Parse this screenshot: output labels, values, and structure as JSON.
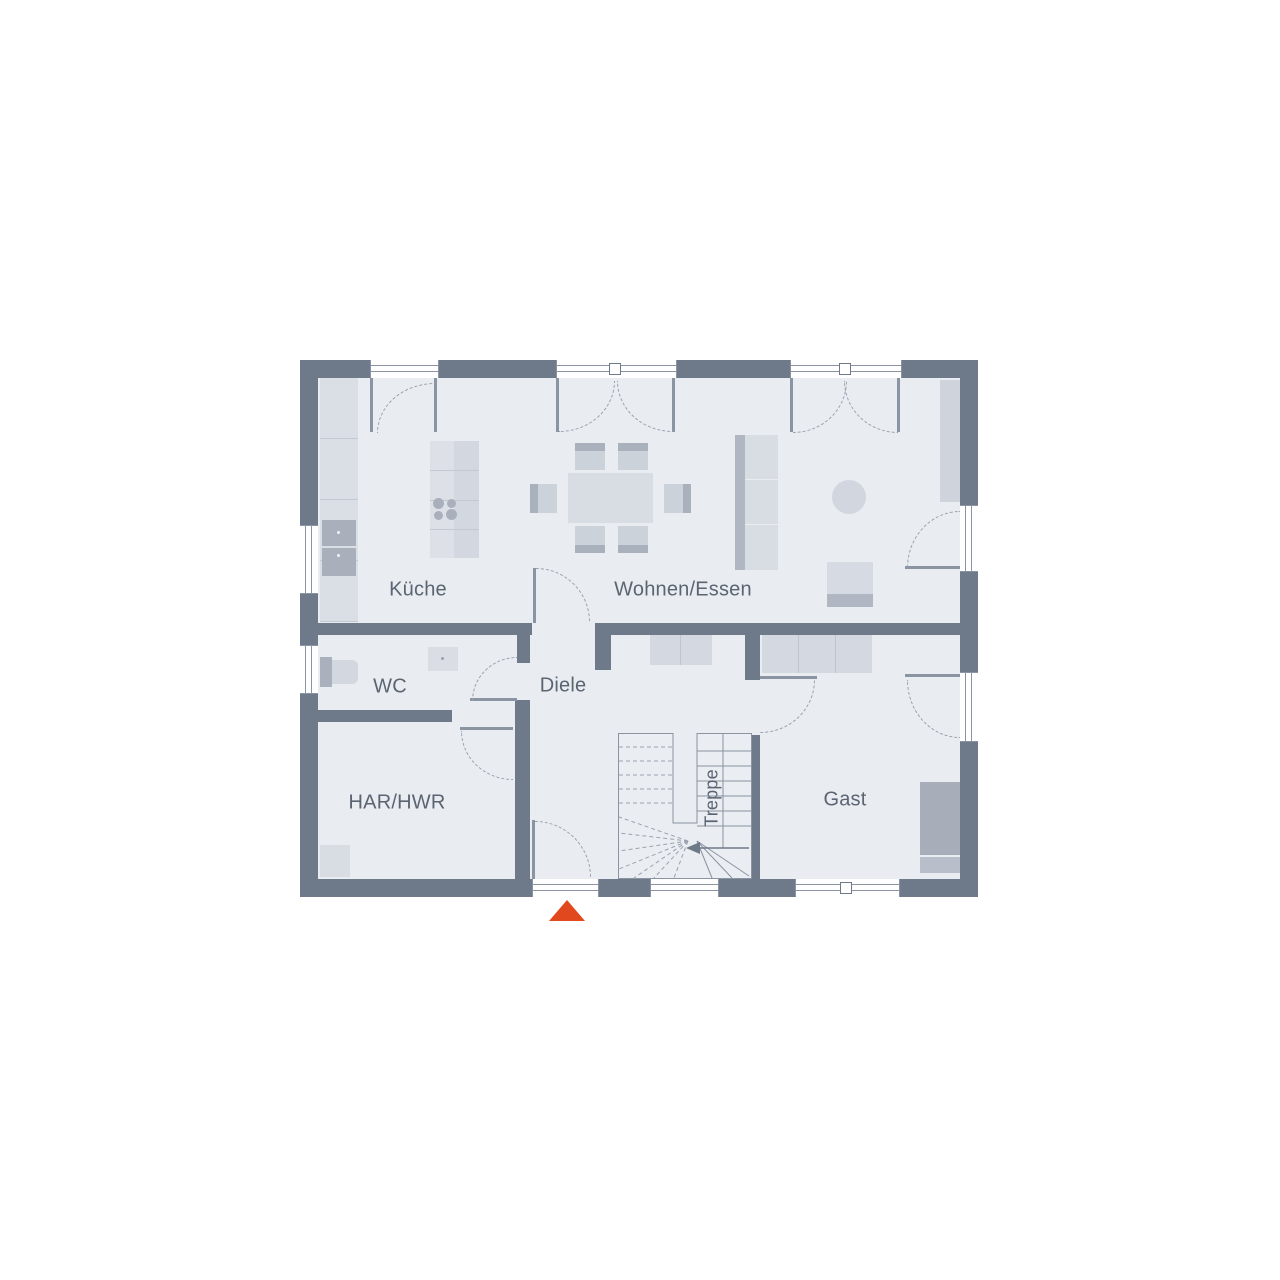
{
  "plan": {
    "type": "floor-plan",
    "rooms": [
      {
        "id": "kueche",
        "label": "Küche"
      },
      {
        "id": "wohnen-essen",
        "label": "Wohnen/Essen"
      },
      {
        "id": "wc",
        "label": "WC"
      },
      {
        "id": "diele",
        "label": "Diele"
      },
      {
        "id": "har-hwr",
        "label": "HAR/HWR"
      },
      {
        "id": "gast",
        "label": "Gast"
      },
      {
        "id": "treppe",
        "label": "Treppe"
      }
    ],
    "colors": {
      "wall": "#6e7a8a",
      "floor": "#e9ecf1",
      "furniture_light": "#d8dce3",
      "furniture_medium": "#c6ccd5",
      "furniture_dark": "#a9b0bc",
      "entrance_marker": "#e2481e",
      "label_text": "#5b6571"
    }
  }
}
